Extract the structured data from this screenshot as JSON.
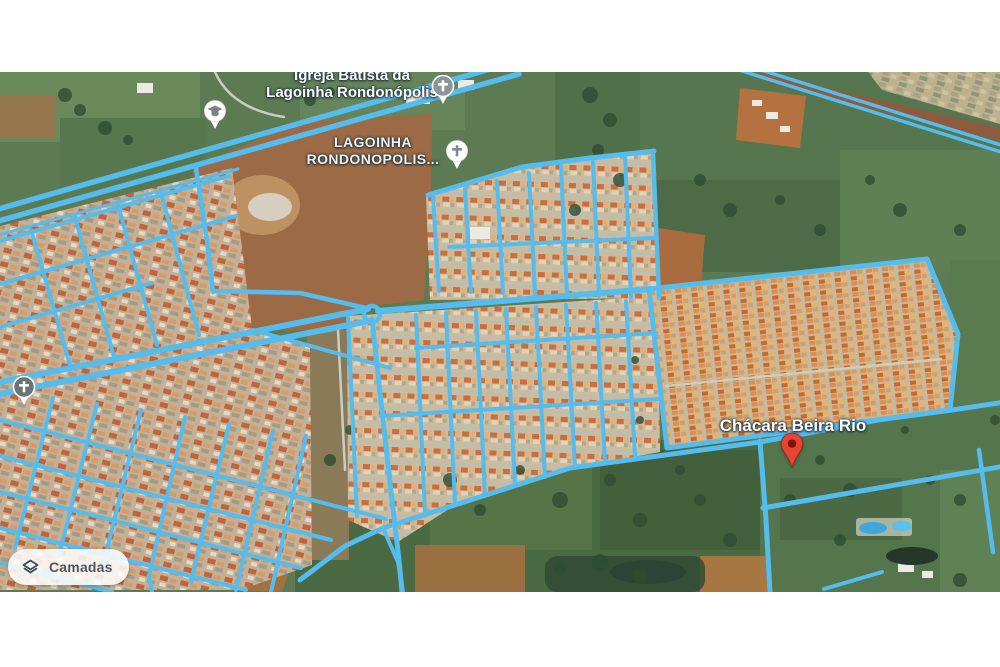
{
  "map": {
    "view_type": "satellite-with-road-overlay",
    "labels": {
      "church_poi": {
        "line1": "Igreja Batista da",
        "line2": "Lagoinha Rondonópolis"
      },
      "neighborhood": {
        "line1": "LAGOINHA",
        "line2": "RONDONOPOLIS..."
      },
      "chacara": {
        "text": "Chácara Beira Rio"
      }
    },
    "markers": [
      {
        "name": "church-marker-top",
        "icon": "cross"
      },
      {
        "name": "church-marker-center",
        "icon": "cross"
      },
      {
        "name": "church-marker-left",
        "icon": "cross"
      },
      {
        "name": "school-marker",
        "icon": "graduation-cap"
      },
      {
        "name": "destination-pin",
        "icon": "red-pin"
      }
    ],
    "colors": {
      "road_overlay": "#55bcee",
      "pin_red": "#ea4335",
      "label_text": "#ffffff",
      "field_green": "#5d7b53",
      "dirt_brown": "#9c6b45"
    }
  },
  "controls": {
    "layers_button": {
      "label": "Camadas",
      "icon": "layers"
    }
  }
}
